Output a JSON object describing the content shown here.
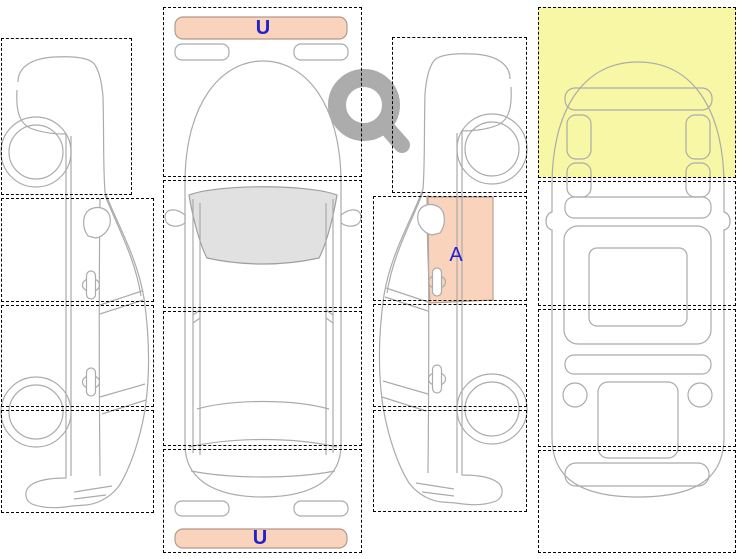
{
  "diagram": {
    "markers": {
      "front_bumper": {
        "code": "U"
      },
      "rear_bumper": {
        "code": "U"
      },
      "right_front_door": {
        "code": "A"
      }
    },
    "colors": {
      "damage_fill": "#f9d3bc",
      "damage_border": "#c0a08f",
      "highlight_fill": "#f7f7a5",
      "marker_text": "#2222cc",
      "car_outline": "#ababab",
      "zone_border": "#000000",
      "glass_fill": "#e1e1e1",
      "magnifier": "#acacac"
    },
    "icons": {
      "magnifier": "magnifier-icon"
    }
  }
}
